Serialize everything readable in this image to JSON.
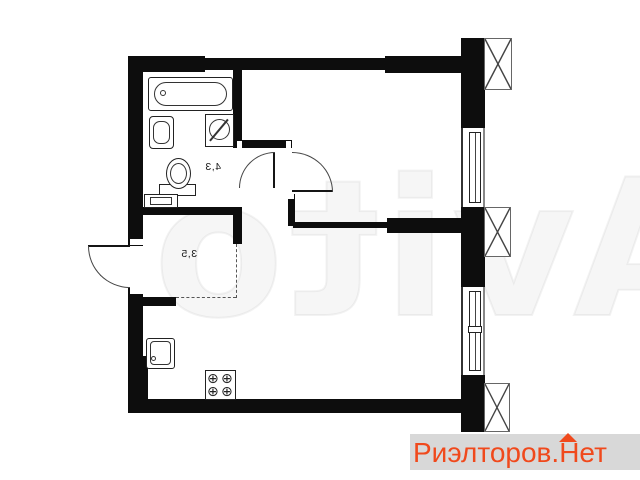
{
  "floorplan": {
    "rooms": [
      {
        "name": "bathroom",
        "area_label": "4,3"
      },
      {
        "name": "hallway",
        "area_label": "3,5"
      }
    ],
    "stove_burner_glyph": "⊕",
    "fixtures": [
      "bathtub",
      "bathroom-sink",
      "washing-machine",
      "toilet",
      "bathroom-shelf",
      "kitchen-sink",
      "stove",
      "entrance-door",
      "bathroom-door",
      "room-door",
      "window-upper",
      "window-lower",
      "ventilation-shaft-top",
      "ventilation-shaft-middle",
      "ventilation-shaft-bottom"
    ],
    "colors": {
      "wall": "#0d0d0d",
      "line": "#2a2a2a"
    }
  },
  "watermark": {
    "text": "Avito"
  },
  "branding": {
    "text": "Риэлторов.Нет",
    "color": "#f0491c",
    "background": "#d8d8d8"
  }
}
